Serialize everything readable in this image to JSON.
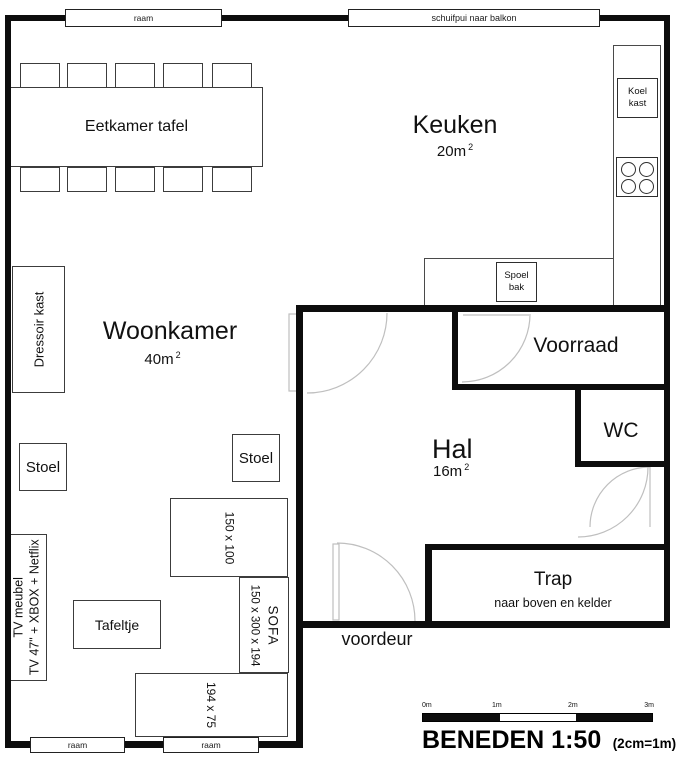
{
  "title": {
    "main": "BENEDEN 1:50",
    "note": "(2cm=1m)"
  },
  "windows": {
    "top": "raam",
    "balcony": "schuifpui naar balkon",
    "bottom_left": "raam",
    "bottom_right": "raam"
  },
  "rooms": {
    "keuken": {
      "name": "Keuken",
      "area": "20m",
      "sup": "2"
    },
    "woonkamer": {
      "name": "Woonkamer",
      "area": "40m",
      "sup": "2"
    },
    "hal": {
      "name": "Hal",
      "area": "16m",
      "sup": "2"
    },
    "voorraad": {
      "name": "Voorraad"
    },
    "wc": {
      "name": "WC"
    },
    "trap": {
      "name": "Trap",
      "note": "naar boven en kelder"
    }
  },
  "doors": {
    "front": "voordeur"
  },
  "furniture": {
    "dining_table": "Eetkamer tafel",
    "dressoir": "Dressoir kast",
    "stoel_left": "Stoel",
    "stoel_right": "Stoel",
    "tv_line1": "TV meubel",
    "tv_line2": "TV 47\" + XBOX + Netflix",
    "tafeltje": "Tafeltje",
    "chaise_dims": "150 x 100",
    "sofa_label": "SOFA",
    "sofa_dims": "150 x 300 x 194",
    "sofa_seat_dims": "194 x 75",
    "koelkast": "Koel kast",
    "spoelbak": "Spoel bak"
  },
  "scalebar": {
    "ticks": [
      "0m",
      "1m",
      "2m",
      "3m"
    ]
  },
  "colors": {
    "wall": "#0d0d0d",
    "arc": "#bfbfbf"
  }
}
